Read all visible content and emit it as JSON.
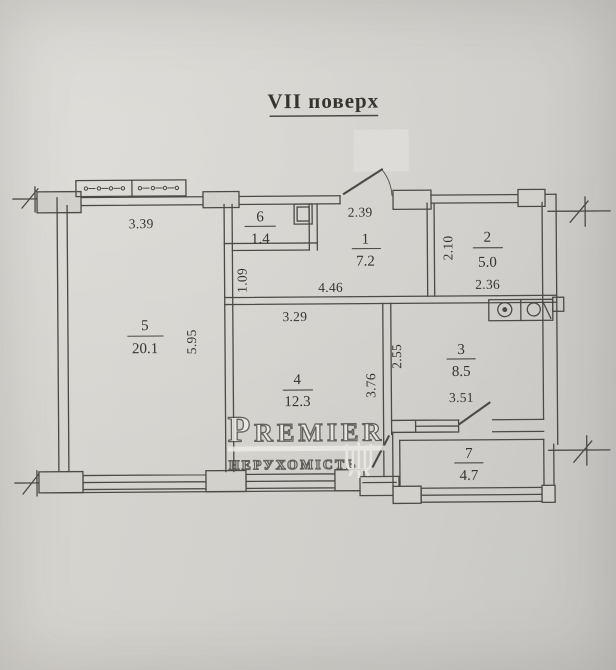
{
  "title": {
    "text": "VII поверх"
  },
  "rooms": [
    {
      "number": "1",
      "area": "7.2"
    },
    {
      "number": "2",
      "area": "5.0"
    },
    {
      "number": "3",
      "area": "8.5"
    },
    {
      "number": "4",
      "area": "12.3"
    },
    {
      "number": "5",
      "area": "20.1"
    },
    {
      "number": "6",
      "area": "1.4"
    },
    {
      "number": "7",
      "area": "4.7"
    }
  ],
  "dimensions": {
    "room5_top_width": "3.39",
    "room1_top_width": "2.39",
    "room6_left_wall": "1.09",
    "room1_bottom_width": "4.46",
    "room2_left_height": "2.10",
    "room2_bottom_width": "2.36",
    "room4_top_width": "3.29",
    "room5_right_height": "5.95",
    "room4_right_height": "3.76",
    "room3_left_height": "2.55",
    "room3_bottom_width": "3.51"
  },
  "watermark": {
    "brand": "Premier",
    "subtitle": "нерухомість"
  },
  "colors": {
    "paper": "#d3d1cc",
    "ink": "#4b4a45",
    "watermark": "#edece7",
    "redaction": "#dedcd8"
  }
}
